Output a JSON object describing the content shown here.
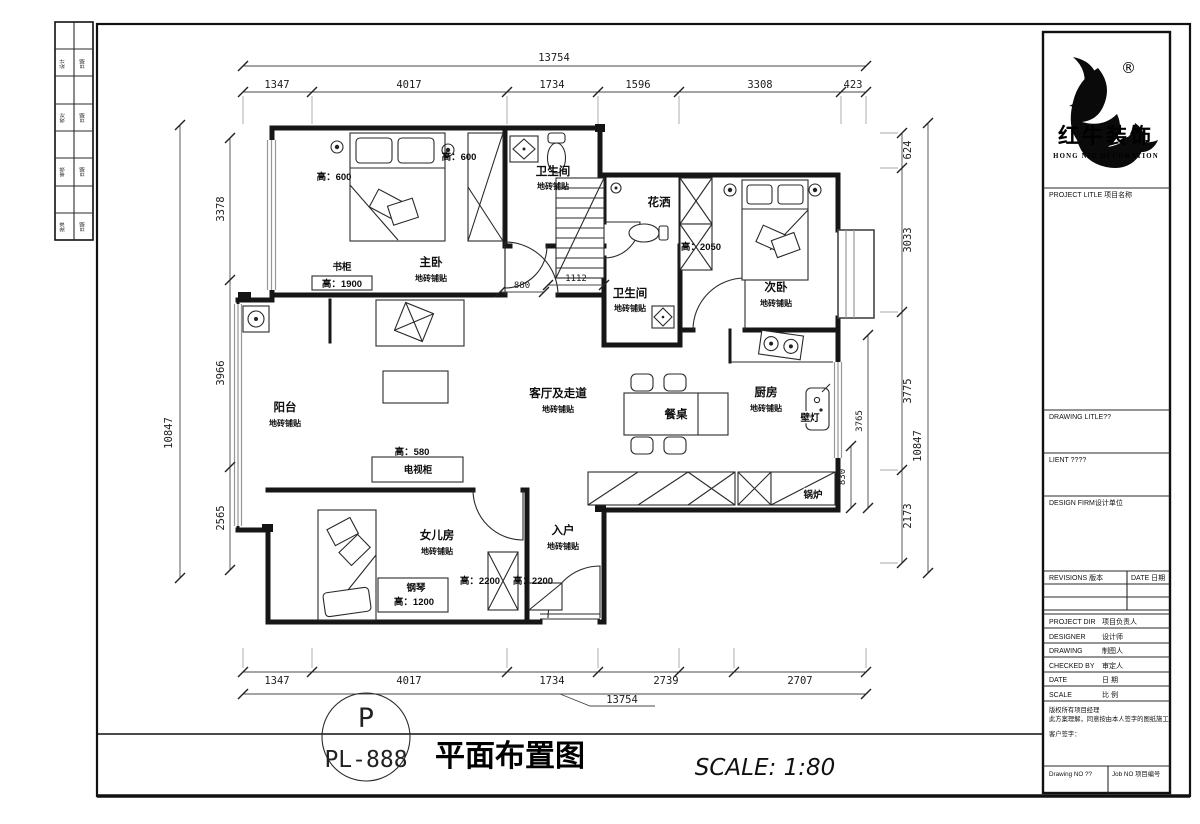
{
  "margin_strip": {
    "rows": [
      {
        "l": "设计",
        "r": "日期"
      },
      {
        "l": "校对",
        "r": "日期"
      },
      {
        "l": "审核",
        "r": "日期"
      },
      {
        "l": "批准",
        "r": "日期"
      }
    ]
  },
  "dims": {
    "top_total": "13754",
    "top": [
      "1347",
      "4017",
      "1734",
      "1596",
      "3308",
      "423"
    ],
    "bottom": [
      "1347",
      "4017",
      "1734",
      "2739",
      "2707"
    ],
    "bottom_total": "13754",
    "left_total": "10847",
    "left": [
      "3378",
      "3966",
      "2565"
    ],
    "right_total": "10847",
    "right": [
      "624",
      "3033",
      "3775",
      "2173"
    ],
    "inner_880": "880",
    "inner_1112": "1112",
    "inner_3765": "3765",
    "inner_830": "830"
  },
  "rooms": {
    "master": {
      "name": "主卧",
      "finish": "地砖铺贴"
    },
    "bath1": {
      "name": "卫生间",
      "finish": "地砖铺贴"
    },
    "shower": {
      "name": "花洒"
    },
    "bath2": {
      "name": "卫生间",
      "finish": "地砖铺贴"
    },
    "bedroom2": {
      "name": "次卧",
      "finish": "地砖铺贴"
    },
    "balcony": {
      "name": "阳台",
      "finish": "地砖铺贴"
    },
    "living": {
      "name": "客厅及走道",
      "finish": "地砖铺贴"
    },
    "dining": {
      "name": "餐桌"
    },
    "kitchen": {
      "name": "厨房",
      "finish": "地砖铺贴"
    },
    "girl": {
      "name": "女儿房",
      "finish": "地砖铺贴"
    },
    "entry": {
      "name": "入户",
      "finish": "地砖铺贴"
    }
  },
  "annotations": {
    "h600_left": "高：600",
    "h600_right": "高：600",
    "bookcase": "书柜",
    "h1900": "高：1900",
    "h2050": "高：2050",
    "tv_h": "高：580",
    "tv": "电视柜",
    "piano": "钢琴",
    "piano_h": "高：1200",
    "h2200_a": "高：2200",
    "h2200_b": "高：2200",
    "boiler": "锅炉",
    "wall_lamp": "壁灯"
  },
  "footer": {
    "circle_top": "P",
    "circle_code": "PL-888",
    "title": "平面布置图",
    "scale": "SCALE: 1:80"
  },
  "title_block": {
    "registered": "®",
    "brand_cn": "红牛装饰",
    "brand_en": "HONG NIU DECORATION",
    "project_title": "PROJECT LITLE 项目名称",
    "drawing_title": "DRAWING LITLE??",
    "client": "LIENT ????",
    "design_firm": "DESIGN FIRM设计单位",
    "revisions": "REVISIONS 版本",
    "date_hdr": "DATE 日期",
    "info_rows": [
      {
        "en": "PROJECT DIR",
        "cn": "项目负责人"
      },
      {
        "en": "DESIGNER",
        "cn": "设计师"
      },
      {
        "en": "DRAWING",
        "cn": "制图人"
      },
      {
        "en": "CHECKED BY",
        "cn": "审定人"
      },
      {
        "en": "DATE",
        "cn": "日 期"
      },
      {
        "en": "SCALE",
        "cn": "比 例"
      }
    ],
    "copyright1": "版权所有项目经理",
    "copyright2": "此方案理解，同意按由本人签字的图纸施工；",
    "signature": "客户签字：",
    "drawing_no": "Drawing NO ??",
    "job_no": "Job NO 项目编号"
  }
}
